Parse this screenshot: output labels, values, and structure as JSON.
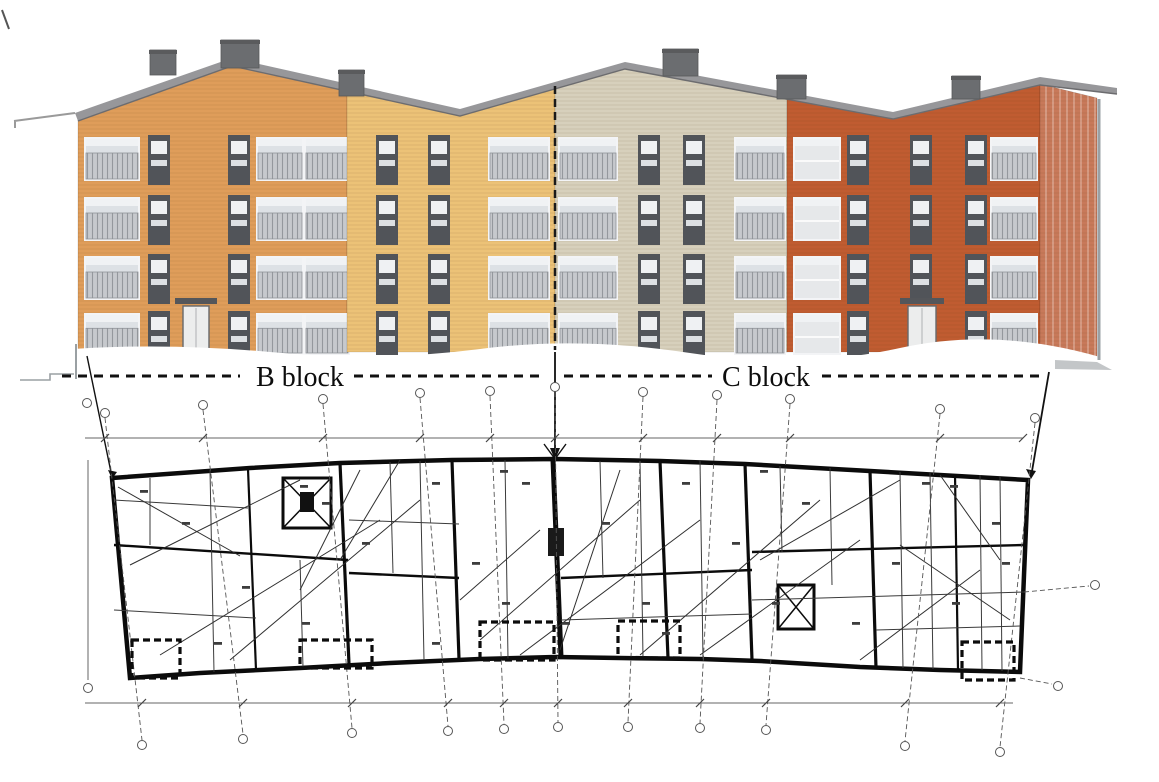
{
  "labels": {
    "b_block": "B block",
    "c_block": "C block"
  },
  "colors": {
    "facade_orange": "#df9d5a",
    "facade_yellow": "#ecc277",
    "facade_beige": "#d7d0bc",
    "facade_rust": "#c05c31",
    "facade_return": "#c8795a",
    "roof_gray": "#97979a",
    "roof_edge": "#6c6c6f",
    "chimney_gray": "#6b6d70",
    "window_glass": "#dde1e5",
    "window_dark_frame": "#515459",
    "railing_gray": "#c6c9cd",
    "plan_ink": "#0b0b0b",
    "grid_gray": "#555555",
    "ground_gray": "#9aa0a3"
  },
  "elevation": {
    "floors": 4,
    "rows": [
      {
        "y": 139,
        "h": 40
      },
      {
        "y": 199,
        "h": 40
      },
      {
        "y": 258,
        "h": 40
      },
      {
        "y": 315,
        "h": 38
      }
    ],
    "roof_poly": "75,113 232,58 460,109 625,62 893,112 1040,77 1117,88 1117,94 1040,85 893,119 625,69 460,116 232,66 78,121",
    "roof_edge_path": "M78,121 L232,66 L460,116 L625,69 L893,119 L1040,85 L1117,94",
    "sections": [
      {
        "name": "orange",
        "color": "#df9d5a",
        "poly": "78,120 232,66 347,90 347,352 78,352",
        "windows": [
          {
            "t": "bal",
            "x": 86,
            "w": 52
          },
          {
            "t": "nar",
            "x": 148,
            "w": 22
          },
          {
            "t": "nar",
            "x": 228,
            "w": 22
          },
          {
            "t": "bal",
            "x": 258,
            "w": 44
          },
          {
            "t": "bal",
            "x": 306,
            "w": 42
          }
        ],
        "door": {
          "x": 183,
          "w": 26
        }
      },
      {
        "name": "yellow",
        "color": "#ecc277",
        "poly": "347,90 460,115 555,83 555,352 347,352",
        "windows": [
          {
            "t": "nar",
            "x": 376,
            "w": 22
          },
          {
            "t": "nar",
            "x": 428,
            "w": 22
          },
          {
            "t": "bal",
            "x": 490,
            "w": 58
          }
        ],
        "door": null
      },
      {
        "name": "beige",
        "color": "#d7d0bc",
        "poly": "555,83 625,68 787,97 787,352 555,352",
        "windows": [
          {
            "t": "bal",
            "x": 560,
            "w": 56
          },
          {
            "t": "nar",
            "x": 638,
            "w": 22
          },
          {
            "t": "nar",
            "x": 683,
            "w": 22
          },
          {
            "t": "bal",
            "x": 736,
            "w": 48
          }
        ],
        "door": null
      },
      {
        "name": "rust",
        "color": "#c05c31",
        "poly": "787,97 893,118 1040,84 1040,352 787,352",
        "windows": [
          {
            "t": "win",
            "x": 795,
            "w": 44
          },
          {
            "t": "nar",
            "x": 847,
            "w": 22
          },
          {
            "t": "nar",
            "x": 910,
            "w": 22
          },
          {
            "t": "nar",
            "x": 965,
            "w": 22
          },
          {
            "t": "bal",
            "x": 992,
            "w": 44
          }
        ],
        "door": {
          "x": 908,
          "w": 28
        }
      },
      {
        "name": "return",
        "color": "#c8795a",
        "poly": "1040,84 1097,98 1097,360 1040,356",
        "windows": [],
        "stripes": true,
        "door": null
      }
    ],
    "chimneys": [
      [
        150,
        50,
        26,
        25
      ],
      [
        221,
        40,
        38,
        28
      ],
      [
        339,
        70,
        25,
        26
      ],
      [
        663,
        49,
        35,
        27
      ],
      [
        777,
        75,
        29,
        24
      ],
      [
        952,
        76,
        28,
        23
      ]
    ]
  },
  "plan": {
    "axes": [
      [
        105,
        418,
        142,
        740
      ],
      [
        203,
        410,
        243,
        734
      ],
      [
        323,
        404,
        352,
        728
      ],
      [
        420,
        398,
        448,
        726
      ],
      [
        490,
        396,
        504,
        724
      ],
      [
        555,
        392,
        558,
        722
      ],
      [
        643,
        397,
        628,
        722
      ],
      [
        717,
        400,
        700,
        723
      ],
      [
        790,
        404,
        766,
        725
      ],
      [
        940,
        414,
        905,
        741
      ],
      [
        1035,
        423,
        1000,
        747
      ]
    ],
    "dims": [
      {
        "y": 438,
        "x1": 85,
        "x2": 1023,
        "ticks": [
          105,
          203,
          323,
          420,
          490,
          555,
          643,
          717,
          790,
          940,
          1023
        ]
      },
      {
        "y": 703,
        "x1": 85,
        "x2": 1013,
        "ticks": [
          142,
          243,
          352,
          448,
          504,
          558,
          628,
          700,
          766,
          905,
          1000
        ]
      }
    ],
    "balconies": [
      [
        132,
        640,
        48,
        38
      ],
      [
        300,
        640,
        72,
        28
      ],
      [
        480,
        622,
        74,
        38
      ],
      [
        618,
        621,
        62,
        37
      ],
      [
        962,
        642,
        52,
        38
      ]
    ],
    "blobs": [
      [
        140,
        490
      ],
      [
        182,
        522
      ],
      [
        242,
        586
      ],
      [
        214,
        642
      ],
      [
        322,
        502
      ],
      [
        302,
        622
      ],
      [
        362,
        542
      ],
      [
        432,
        482
      ],
      [
        472,
        562
      ],
      [
        502,
        602
      ],
      [
        522,
        482
      ],
      [
        602,
        522
      ],
      [
        642,
        602
      ],
      [
        682,
        482
      ],
      [
        732,
        542
      ],
      [
        772,
        602
      ],
      [
        802,
        502
      ],
      [
        852,
        622
      ],
      [
        892,
        562
      ],
      [
        922,
        482
      ],
      [
        952,
        602
      ],
      [
        992,
        522
      ],
      [
        1002,
        562
      ],
      [
        432,
        642
      ],
      [
        562,
        622
      ],
      [
        662,
        632
      ],
      [
        300,
        485
      ],
      [
        500,
        470
      ],
      [
        760,
        470
      ],
      [
        950,
        485
      ]
    ]
  }
}
